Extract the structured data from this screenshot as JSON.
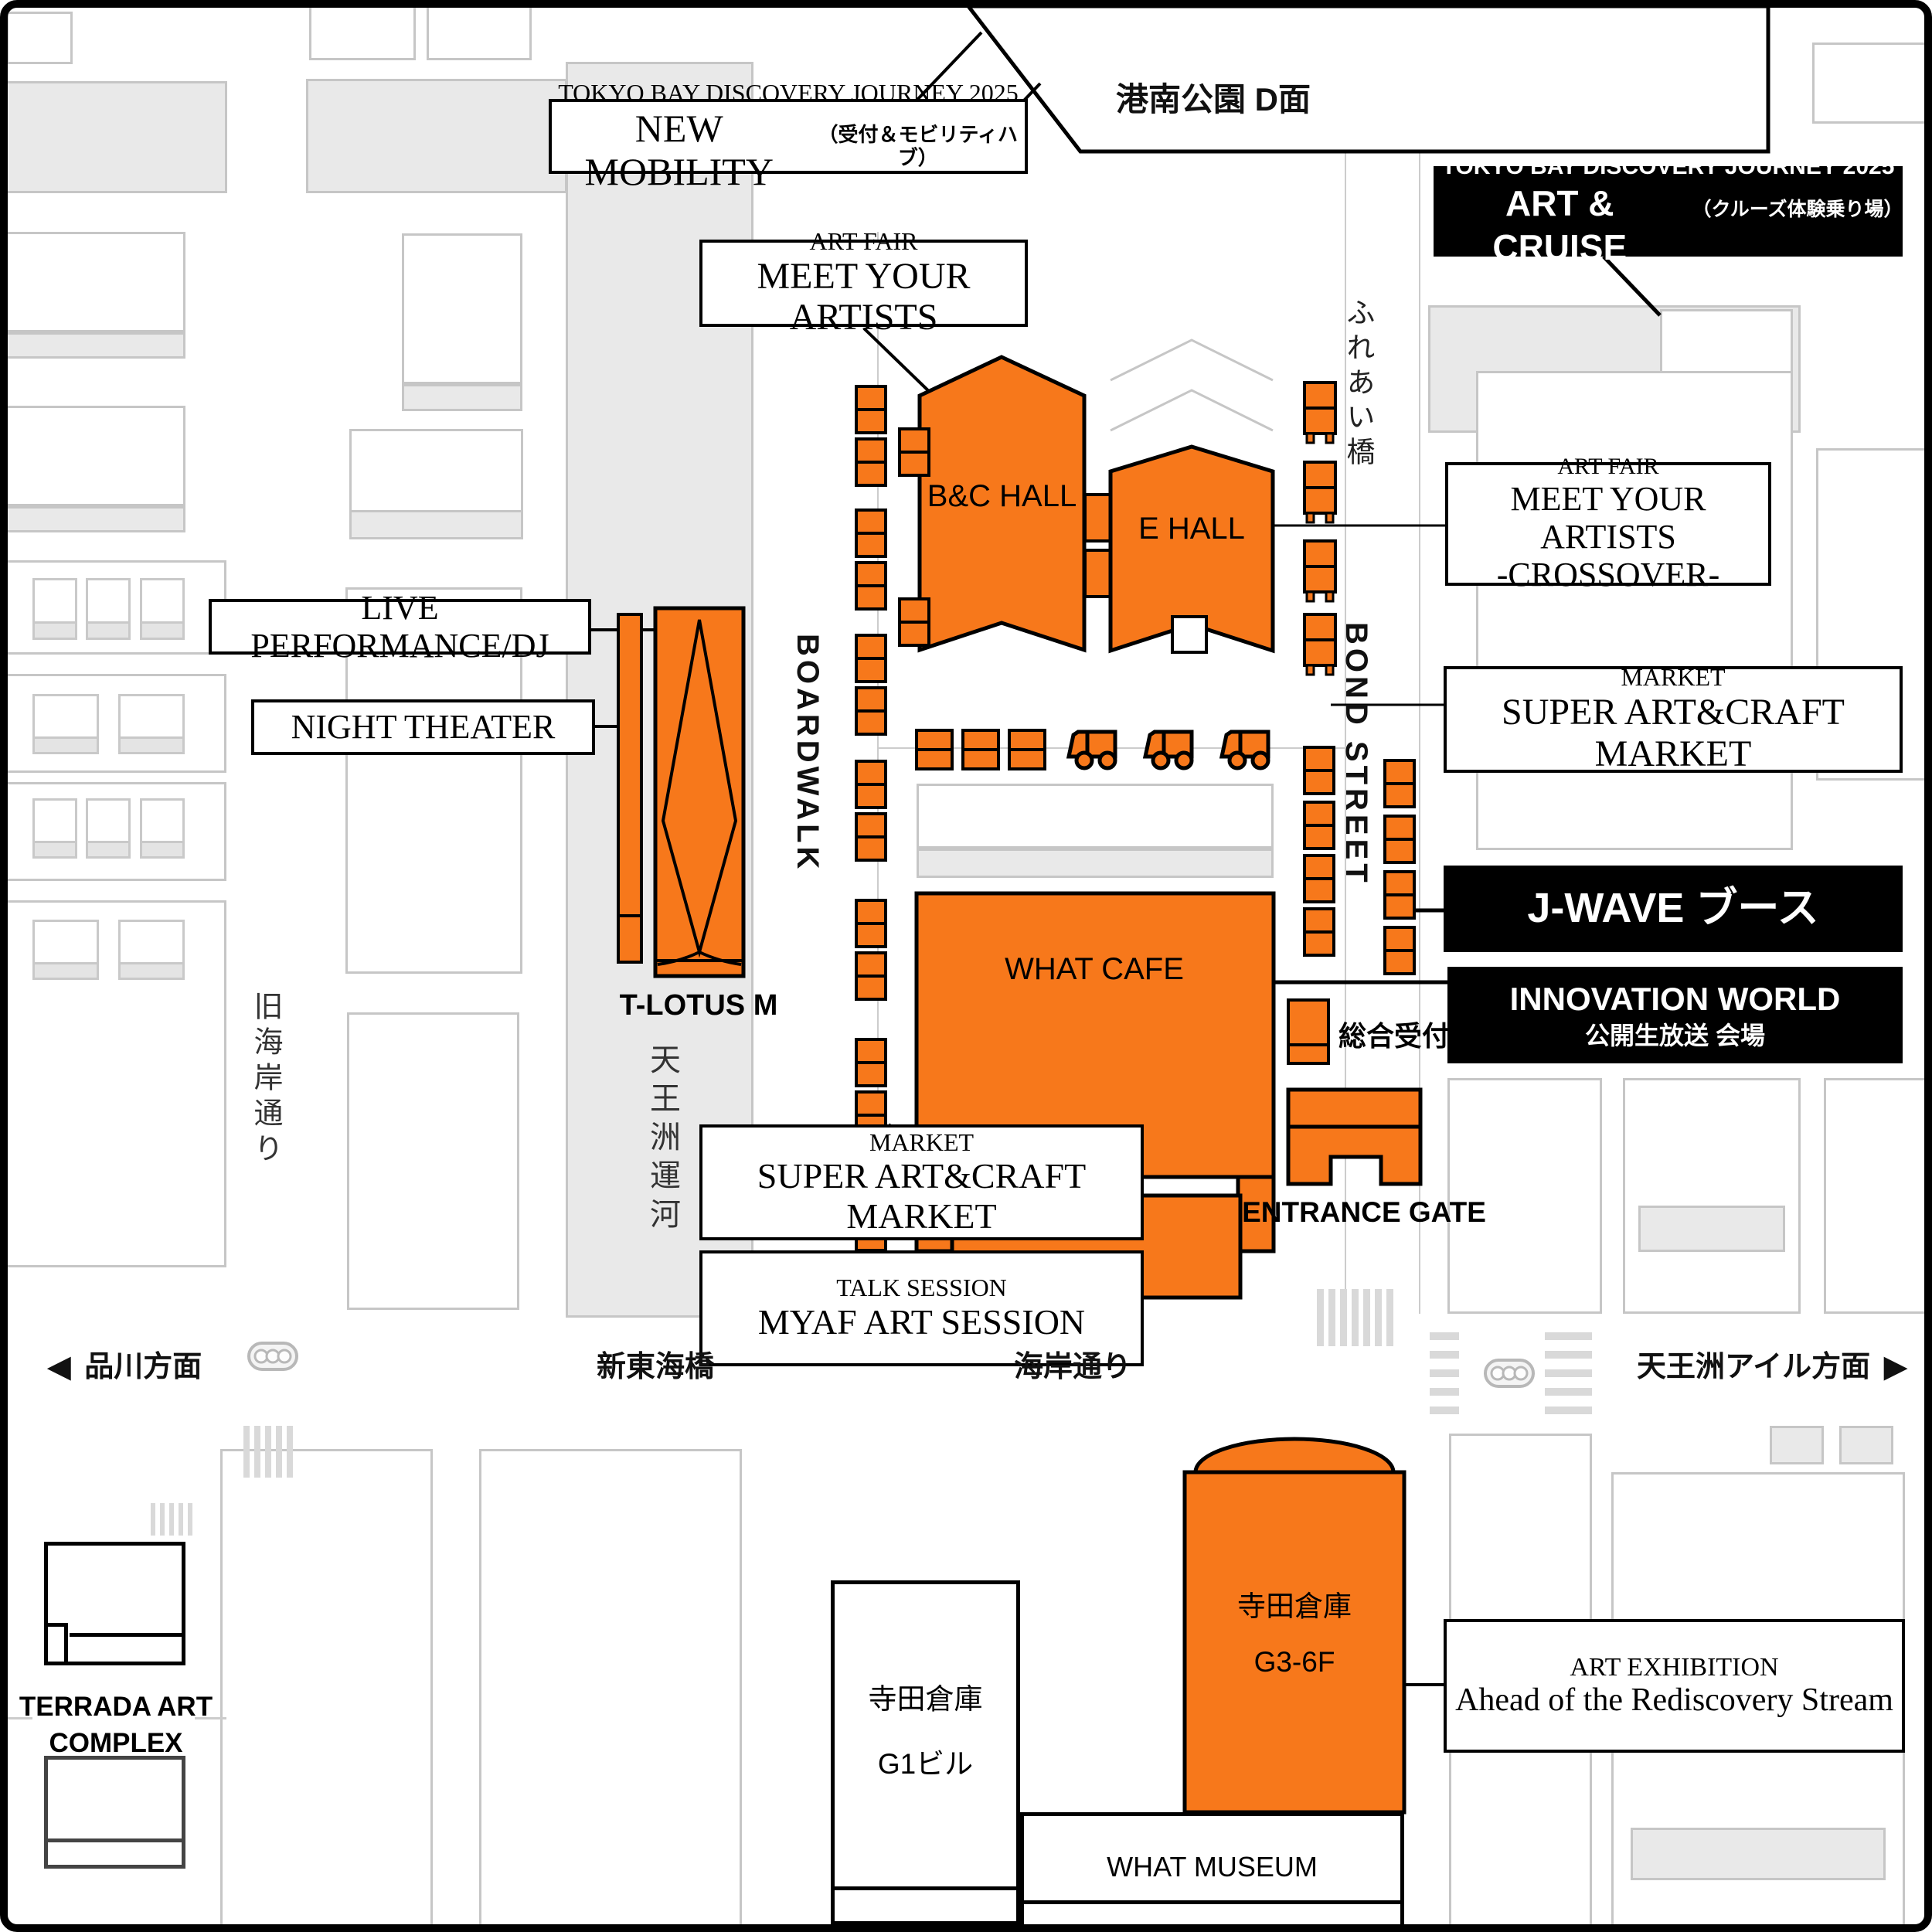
{
  "event": {
    "title": "TOKYO BAY DISCOVERY JOURNEY 2025"
  },
  "labels": {
    "new_mobility": {
      "title": "TOKYO BAY DISCOVERY JOURNEY 2025",
      "name": "NEW MOBILITY",
      "sub": "（受付＆モビリティハブ）"
    },
    "art_cruise": {
      "title": "TOKYO BAY DISCOVERY JOURNEY 2025",
      "name": "ART & CRUISE",
      "sub": "（クルーズ体験乗り場）"
    },
    "art_fair": {
      "category": "ART FAIR",
      "name": "MEET YOUR ARTISTS"
    },
    "crossover": {
      "category": "ART FAIR",
      "name": "MEET YOUR ARTISTS",
      "sub": "-CROSSOVER-"
    },
    "market_right": {
      "category": "MARKET",
      "name": "SUPER ART&CRAFT MARKET"
    },
    "market_bottom": {
      "category": "MARKET",
      "name": "SUPER ART&CRAFT MARKET"
    },
    "talk_session": {
      "category": "TALK SESSION",
      "name": "MYAF ART SESSION"
    },
    "live_dj": "LIVE PERFORMANCE/DJ",
    "night_theater": "NIGHT THEATER",
    "jwave_booth": "J-WAVE ブース",
    "innovation": {
      "line1": "INNOVATION WORLD",
      "line2": "公開生放送 会場"
    },
    "art_exhibition": {
      "category": "ART EXHIBITION",
      "name": "Ahead of the Rediscovery Stream"
    }
  },
  "venues": {
    "bc_hall": "B&C HALL",
    "e_hall": "E HALL",
    "what_cafe": "WHAT CAFE",
    "t_lotus": "T-LOTUS M",
    "reception": "総合受付",
    "entrance_gate": "ENTRANCE GATE",
    "konan_park": "港南公園 D面",
    "terada_g3": {
      "line1": "寺田倉庫",
      "line2": "G3-6F"
    },
    "terada_g1": {
      "line1": "寺田倉庫",
      "line2": "G1ビル"
    },
    "what_museum": "WHAT MUSEUM",
    "terrada_complex": {
      "line1": "TERRADA ART",
      "line2": "COMPLEX"
    }
  },
  "roads": {
    "boardwalk": "BOARDWALK",
    "bond_street": "BOND STREET",
    "fureai_bridge": "ふれあい橋",
    "tennozu_canal": "天王洲運河",
    "kyu_kaigan_dori": "旧海岸通り",
    "shin_tokai_bridge": "新東海橋",
    "kaigan_dori": "海岸通り",
    "to_shinagawa": "品川方面",
    "to_tennozu_isle": "天王洲アイル方面",
    "arrow_left": "◀",
    "arrow_right": "▶"
  },
  "colors": {
    "accent_orange": "#F7781B",
    "label_black": "#000000",
    "block_gray": "#e9e9e9"
  }
}
